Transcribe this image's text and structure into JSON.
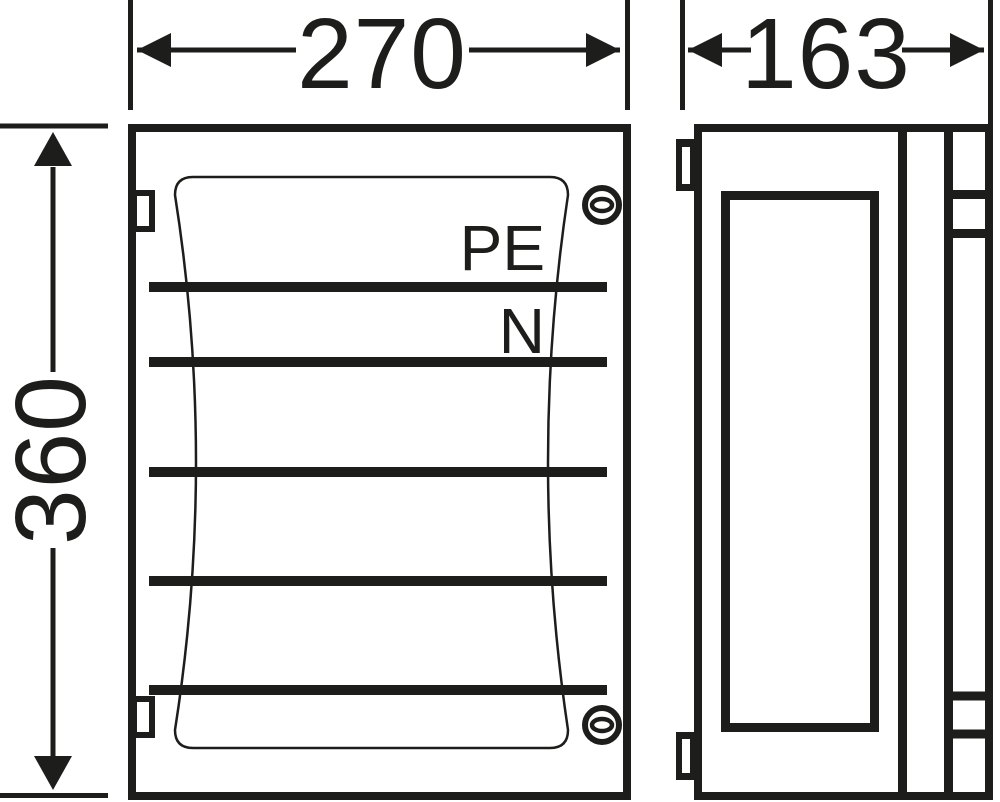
{
  "drawing": {
    "type": "enclosure-dimension-drawing",
    "front_view": {
      "width_dimension": "270",
      "height_dimension": "360",
      "busbar_count": 5,
      "busbar_labels": {
        "pe": "PE",
        "n": "N"
      },
      "screw_count": 2,
      "hinge_tab_count": 2
    },
    "side_view": {
      "depth_dimension": "163",
      "hinge_tab_count": 2
    },
    "colors": {
      "line": "#1d1d1b",
      "background": "#ffffff"
    }
  }
}
